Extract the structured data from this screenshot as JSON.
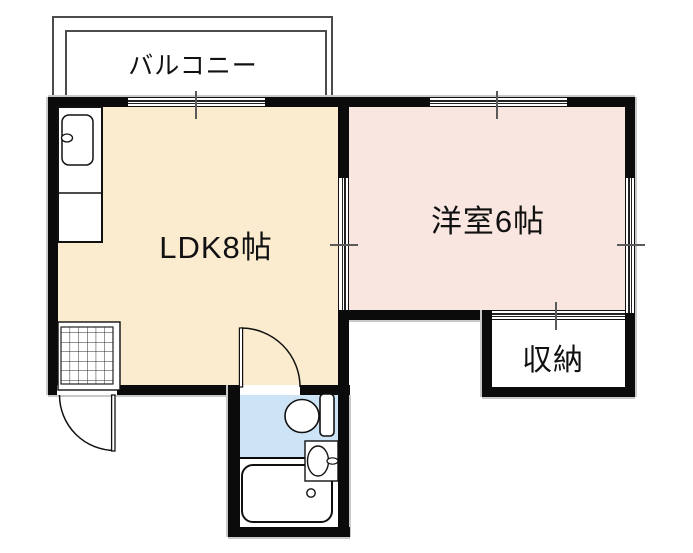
{
  "floor_plan": {
    "balcony": {
      "label": "バルコニー"
    },
    "ldk": {
      "label": "LDK8帖",
      "fill": "#fbeccf"
    },
    "western_room": {
      "label": "洋室6帖",
      "fill": "#f9e6e0"
    },
    "storage": {
      "label": "収納",
      "fill": "#ffffff"
    },
    "sanitary": {
      "toilet_room_fill": "#cce4f6",
      "bath_room_fill": "#ffffff"
    },
    "colors": {
      "wall": "#0b0b0b",
      "outer_outline": "#c9c9c9",
      "balcony_line": "#4c4c4c",
      "tick": "#5a5a5a",
      "fixture_line": "#111111"
    }
  }
}
